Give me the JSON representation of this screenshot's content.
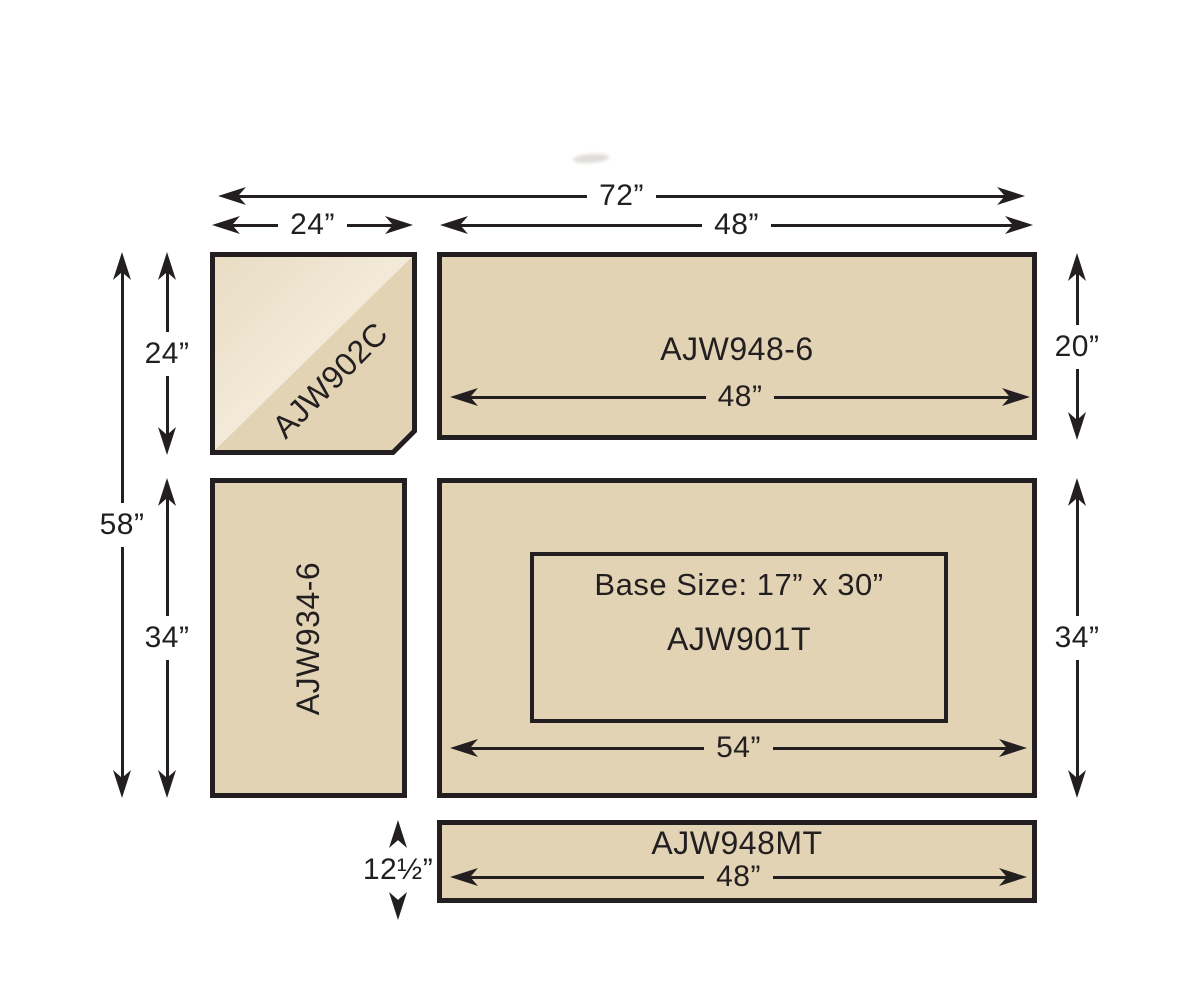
{
  "diagram_title": "Desk configuration footprint diagram",
  "colors": {
    "ink": "#231f20",
    "tan": "#e2d3b4",
    "tan-light-a": "#e8dcc3",
    "tan-light-b": "#f5eedd",
    "paper": "#ffffff"
  },
  "dims": {
    "overall_width": "72”",
    "corner_width": "24”",
    "hutch_top_width": "48”",
    "left_total_height": "58”",
    "corner_height": "24”",
    "return_height": "34”",
    "hutch_height": "20”",
    "hutch_inner_width": "48”",
    "desk_height": "34”",
    "desk_inner_width": "54”",
    "modesty_height": "12½”",
    "modesty_inner_width": "48”"
  },
  "pieces": {
    "corner": {
      "label": "AJW902C"
    },
    "hutch": {
      "label": "AJW948-6"
    },
    "return": {
      "label": "AJW934-6"
    },
    "desk": {
      "label": "AJW901T",
      "base_size": "Base Size: 17” x 30”"
    },
    "modesty": {
      "label": "AJW948MT"
    }
  }
}
